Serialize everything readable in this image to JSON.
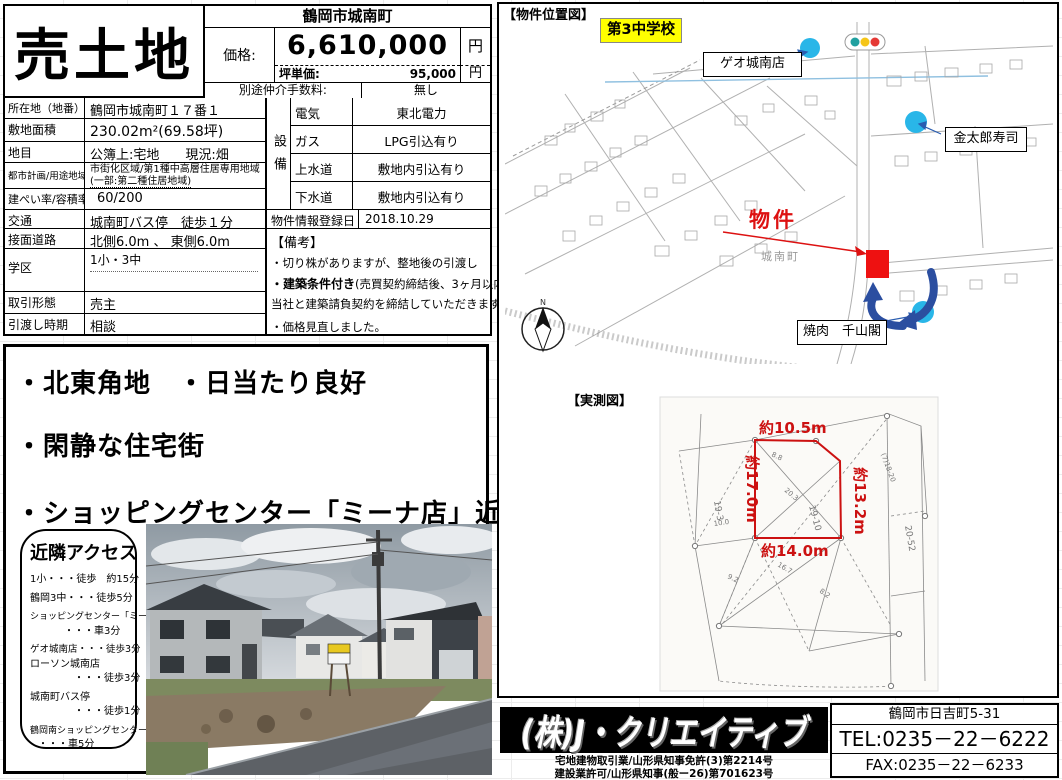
{
  "title": "売土地",
  "price_table": {
    "location_header": "鶴岡市城南町",
    "price_label": "価格:",
    "price_value": "6,610,000",
    "price_unit": "円",
    "tsubo_label": "坪単価:",
    "tsubo_value": "95,000",
    "tsubo_unit": "円",
    "fee_label": "別途仲介手数料:",
    "fee_value": "無し"
  },
  "details": {
    "rows": [
      {
        "label": "所在地（地番）",
        "value": "鶴岡市城南町１７番１"
      },
      {
        "label": "敷地面積",
        "value": "230.02m²(69.58坪)"
      },
      {
        "label": "地目",
        "value": "公簿上:宅地　　現況:畑"
      },
      {
        "label": "都市計画/用途地域",
        "value": "市街化区域/第1種中高層住居専用地域",
        "value2": "(一部:第二種住居地域)"
      },
      {
        "label": "建ぺい率/容積率",
        "value": "60/200"
      },
      {
        "label": "交通",
        "value": "城南町バス停　徒歩１分"
      },
      {
        "label": "接面道路",
        "value": "北側6.0m 、 東側6.0m"
      },
      {
        "label": "学区",
        "value": "1小・3中"
      },
      {
        "label": "取引形態",
        "value": "売主"
      },
      {
        "label": "引渡し時期",
        "value": "相談"
      }
    ]
  },
  "utilities": {
    "header_vertical": "設備",
    "rows": [
      {
        "label": "電気",
        "value": "東北電力"
      },
      {
        "label": "ガス",
        "value": "LPG引込有り"
      },
      {
        "label": "上水道",
        "value": "敷地内引込有り"
      },
      {
        "label": "下水道",
        "value": "敷地内引込有り"
      }
    ]
  },
  "registration": {
    "label": "物件情報登録日",
    "value": "2018.10.29"
  },
  "remarks": {
    "header": "【備考】",
    "lines": [
      {
        "b": "",
        "t": "・切り株がありますが、整地後の引渡し"
      },
      {
        "b": "・建築条件付き",
        "t": "(売買契約締結後、3ヶ月以内に"
      },
      {
        "b": "",
        "t": "当社と建築請負契約を締結していただきます。)"
      },
      {
        "b": "",
        "t": "・価格見直しました。"
      }
    ]
  },
  "features": [
    "・北東角地　・日当たり良好",
    "・閑静な住宅街",
    "・ショッピングセンター「ミーナ店」近し"
  ],
  "access": {
    "title": "近隣アクセス",
    "lines": [
      "1小・・・徒歩　約15分",
      "鶴岡3中・・・徒歩5分",
      "ショッピングセンター「ミーナ」",
      "・・・車3分",
      "ゲオ城南店・・・徒歩3分",
      "ローソン城南店",
      "・・・徒歩3分",
      "城南町バス停",
      "・・・徒歩1分",
      "鶴岡南ショッピングセンター",
      "・・・車5分"
    ]
  },
  "map": {
    "section_title": "【物件位置図】",
    "labels": {
      "school": "第3中学校",
      "geo": "ゲオ城南店",
      "sushi": "金太郎寿司",
      "yakiniku": "焼肉　千山閣",
      "property": "物件",
      "district": "城南町",
      "compass_n": "N"
    }
  },
  "survey": {
    "section_title": "【実測図】",
    "measurements": {
      "top": "約10.5m",
      "left": "約17.0m",
      "right": "約13.2m",
      "bottom": "約14.0m"
    },
    "annotations": [
      "10.0",
      "20.3",
      "8.8",
      "16.7",
      "9.2",
      "19-3",
      "19-10",
      "20-52",
      "(7)18-20",
      "8.2"
    ]
  },
  "footer": {
    "company": "(株)J・クリエイティブ",
    "license1": "宅地建物取引業/山形県知事免許(3)第2214号",
    "license2": "建設業許可/山形県知事(般ー26)第701623号",
    "address": "鶴岡市日吉町5-31",
    "tel": "TEL:0235－22－6222",
    "fax": "FAX:0235－22－6233"
  },
  "colors": {
    "highlight_yellow": "#ffff00",
    "marker_blue": "#29b6e8",
    "property_red": "#dd1111",
    "route_blue": "#2b4ea0"
  }
}
